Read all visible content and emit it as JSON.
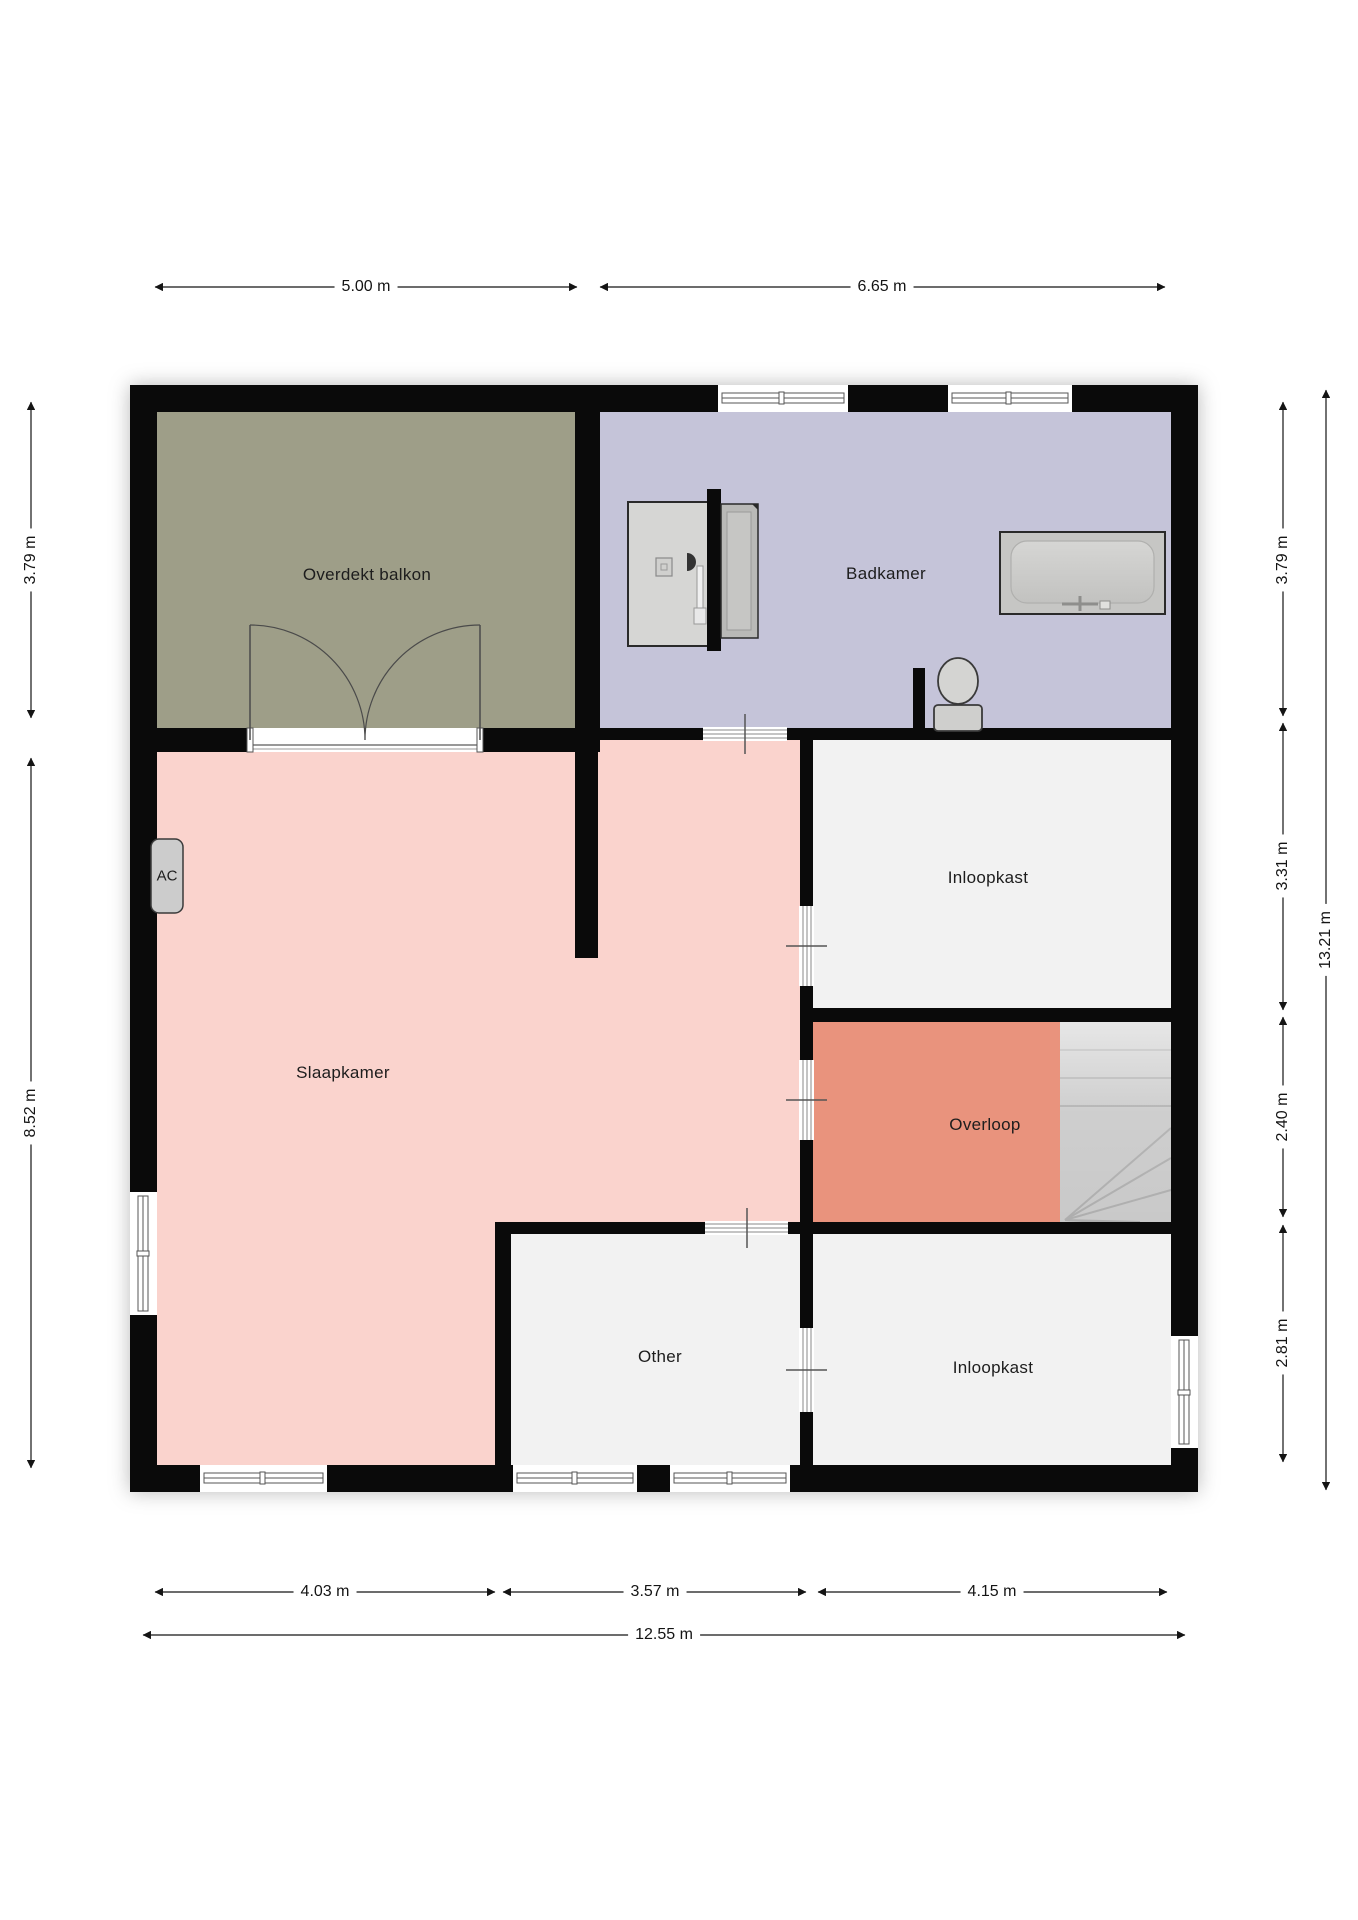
{
  "rooms": [
    {
      "id": "overdekt-balkon",
      "label": "Overdekt balkon"
    },
    {
      "id": "badkamer",
      "label": "Badkamer"
    },
    {
      "id": "slaapkamer",
      "label": "Slaapkamer"
    },
    {
      "id": "inloopkast-top",
      "label": "Inloopkast"
    },
    {
      "id": "overloop",
      "label": "Overloop"
    },
    {
      "id": "other",
      "label": "Other"
    },
    {
      "id": "inloopkast-bottom",
      "label": "Inloopkast"
    }
  ],
  "fixtures": {
    "ac_unit": "AC"
  },
  "dimensions": {
    "top": [
      "5.00 m",
      "6.65 m"
    ],
    "left": [
      "3.79 m",
      "8.52 m"
    ],
    "right": [
      "3.79 m",
      "3.31 m",
      "2.40 m",
      "2.81 m"
    ],
    "right_total": "13.21 m",
    "bottom": [
      "4.03 m",
      "3.57 m",
      "4.15 m"
    ],
    "bottom_total": "12.55 m"
  },
  "colors": {
    "balcony": "#9e9e88",
    "bathroom": "#c5c4d9",
    "bedroom": "#fad3cd",
    "landing": "#e9937d",
    "room_white": "#f2f2f2",
    "stairs": "#c9c9c9",
    "wall": "#0a0a0a"
  }
}
